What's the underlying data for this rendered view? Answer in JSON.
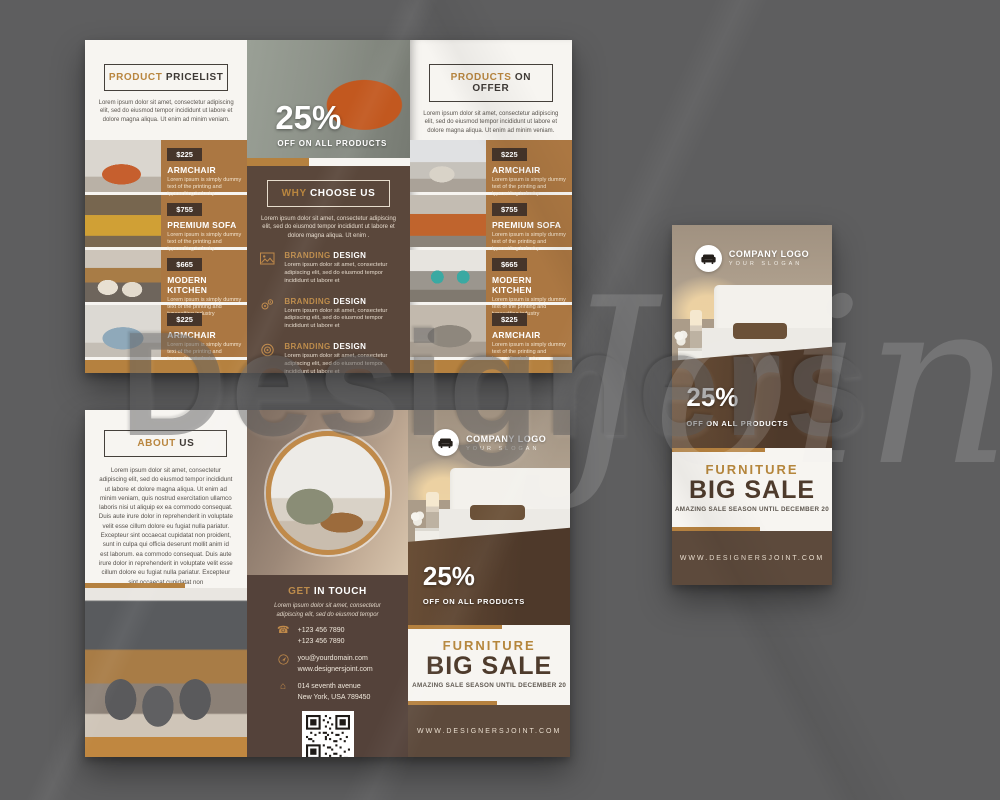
{
  "palette": {
    "background_gray": "#5e5e5f",
    "paper_white": "#f7f5f1",
    "brown_dark": "#5a473b",
    "brown_footer": "#5d4a3c",
    "tan_row": "#ab7742",
    "gold_accent": "#b5813f",
    "gold_text": "#b9863f",
    "price_chip": "#46352a"
  },
  "watermark": {
    "part1": "Designers",
    "part2": "Joint"
  },
  "products": [
    {
      "price": "$225",
      "name": "ARMCHAIR",
      "desc": "Lorem ipsum is simply dummy text of the printing and typesetting industry"
    },
    {
      "price": "$755",
      "name": "PREMIUM SOFA",
      "desc": "Lorem ipsum is simply dummy text of the printing and typesetting industry"
    },
    {
      "price": "$665",
      "name": "MODERN KITCHEN",
      "desc": "Lorem ipsum is simply dummy text of the printing and typesetting industry"
    },
    {
      "price": "$225",
      "name": "ARMCHAIR",
      "desc": "Lorem ipsum is simply dummy text of the printing and typesetting industry"
    }
  ],
  "pricelist": {
    "title_accent": "PRODUCT",
    "title_rest": "PRICELIST",
    "intro": "Lorem ipsum dolor sit amet, consectetur adipiscing elit, sed do eiusmod tempor incididunt ut labore et dolore magna aliqua. Ut enim ad minim veniam."
  },
  "offer": {
    "title_accent": "PRODUCTS",
    "title_rest": "ON OFFER",
    "intro": "Lorem ipsum dolor sit amet, consectetur adipiscing elit, sed do eiusmod tempor incididunt ut labore et dolore magna aliqua. Ut enim ad minim veniam."
  },
  "why": {
    "discount": "25%",
    "discount_sub": "OFF ON ALL PRODUCTS",
    "title_accent": "WHY",
    "title_rest": "CHOOSE US",
    "intro": "Lorem ipsum dolor sit amet, consectetur adipiscing elit, sed do eiusmod tempor incididunt ut labore et dolore magna aliqua. Ut enim .",
    "features": [
      {
        "icon": "image-icon",
        "title_accent": "BRANDING",
        "title_rest": "DESIGN",
        "desc": "Lorem ipsum dolor sit amet, consectetur adipiscing elit, sed do eiusmod tempor incididunt ut labore et"
      },
      {
        "icon": "gears-icon",
        "title_accent": "BRANDING",
        "title_rest": "DESIGN",
        "desc": "Lorem ipsum dolor sit amet, consectetur adipiscing elit, sed do eiusmod tempor incididunt ut labore et"
      },
      {
        "icon": "target-icon",
        "title_accent": "BRANDING",
        "title_rest": "DESIGN",
        "desc": "Lorem ipsum dolor sit amet, consectetur adipiscing elit, sed do eiusmod tempor incididunt ut labore et"
      }
    ]
  },
  "about": {
    "title_accent": "ABOUT",
    "title_rest": "US",
    "body": "Lorem ipsum dolor sit amet, consectetur adipiscing elit, sed do eiusmod tempor incididunt ut labore et dolore magna aliqua. Ut enim ad minim veniam, quis nostrud exercitation ullamco laboris nisi ut aliquip ex ea commodo consequat. Duis aute irure dolor in reprehenderit in voluptate velit esse cillum dolore eu fugiat nulla pariatur. Excepteur sint occaecat cupidatat non proident, sunt in culpa qui officia deserunt mollit anim id est laborum. ea commodo consequat. Duis aute irure dolor in reprehenderit in voluptate velit esse cillum dolore eu fugiat nulla pariatur. Excepteur sint occaecat cupidatat non"
  },
  "contact": {
    "title_accent": "GET",
    "title_rest": "IN TOUCH",
    "intro": "Lorem ipsum dolor sit amet, consectetur adipiscing elit, sed do eiusmod tempor",
    "phones": [
      "+123 456 7890",
      "+123 456 7890"
    ],
    "web": [
      "you@yourdomain.com",
      "www.designersjoint.com"
    ],
    "address": [
      "014 seventh avenue",
      "New York, USA 789450"
    ]
  },
  "cover": {
    "logo_title": "COMPANY LOGO",
    "logo_slogan": "YOUR SLOGAN",
    "discount": "25%",
    "discount_sub": "OFF ON ALL PRODUCTS",
    "headline_accent": "FURNITURE",
    "headline": "BIG SALE",
    "subline": "AMAZING SALE SEASON UNTIL DECEMBER 20",
    "website": "WWW.DESIGNERSJOINT.COM"
  }
}
